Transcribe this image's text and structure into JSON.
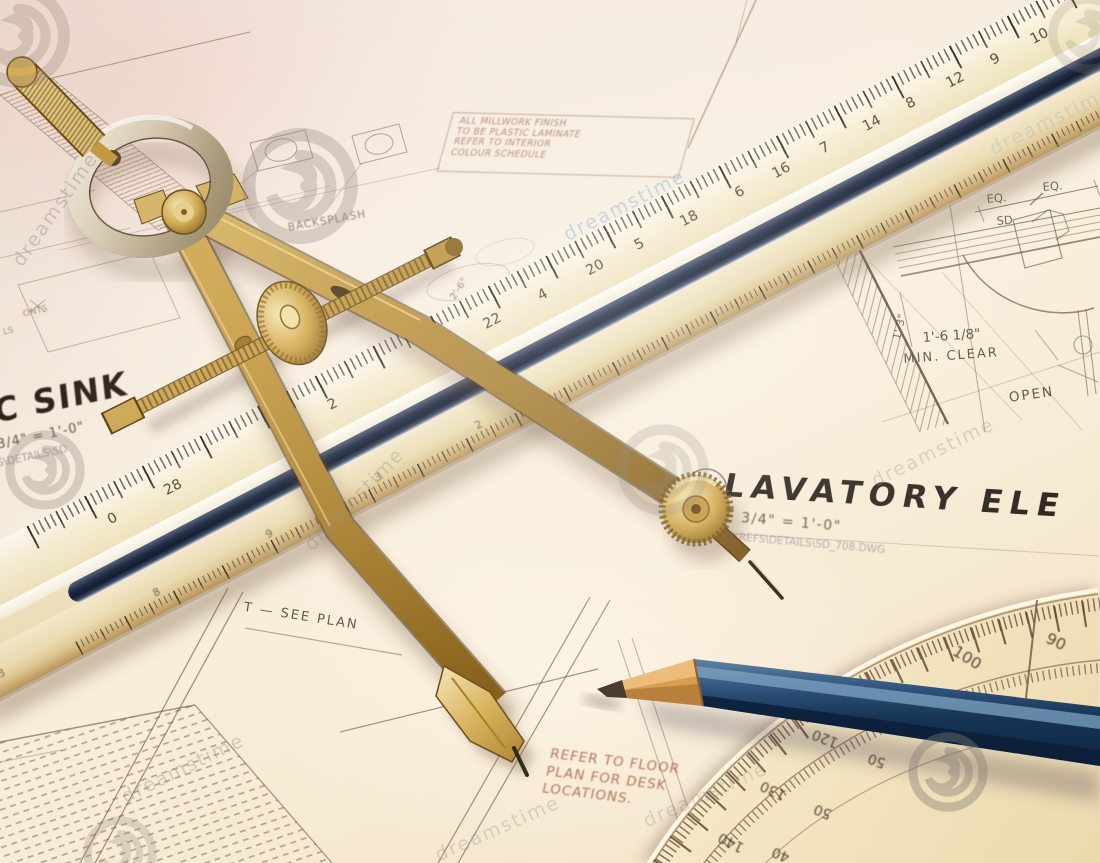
{
  "watermark": {
    "brand": "dreamstime"
  },
  "drawings": {
    "sink_detail": {
      "title": "C SINK",
      "scale": "3/4\" = 1'-0\"",
      "cad_path": "S\\DETAILS\\SD",
      "frag_top": "ONTS",
      "frag_side": "LS",
      "backsplash": "BACKSPLASH",
      "dim": "2'-6\""
    },
    "millwork_note": {
      "line1": "ALL MILLWORK FINISH",
      "line2": "TO BE PLASTIC LAMINATE",
      "line3": "REFER TO INTERIOR",
      "line4": "COLOUR SCHEDULE"
    },
    "lavatory": {
      "title": "LAVATORY ELE",
      "scale": "CALE 3/4\" = 1'-0\"",
      "cad_path": "9\\WO\\XREFS\\DETAILS\\SD_708.DWG",
      "eq_left": "EQ.",
      "eq_right": "EQ.",
      "sd": "SD",
      "height_dim": "1'-3\"",
      "clear_dim": "1'-6 1/8\"",
      "min_clear": "MIN. CLEAR",
      "open": "OPEN"
    },
    "floor_note": {
      "line1": "REFER TO FLOOR",
      "line2": "PLAN FOR DESK",
      "line3": "LOCATIONS."
    },
    "see_plan": "T — SEE PLAN"
  },
  "ruler": {
    "top_scale": [
      "0",
      "28",
      "2",
      "22",
      "4",
      "20",
      "5",
      "18",
      "6",
      "16",
      "7",
      "14",
      "8",
      "12",
      "9",
      "10"
    ],
    "bevel_scale": [
      "3",
      "8",
      "9",
      "3",
      "2"
    ]
  },
  "protractor": {
    "outer_scale": [
      "100",
      "90"
    ],
    "inner_scale": [
      "120",
      "50",
      "130",
      "50",
      "140",
      "40"
    ]
  }
}
